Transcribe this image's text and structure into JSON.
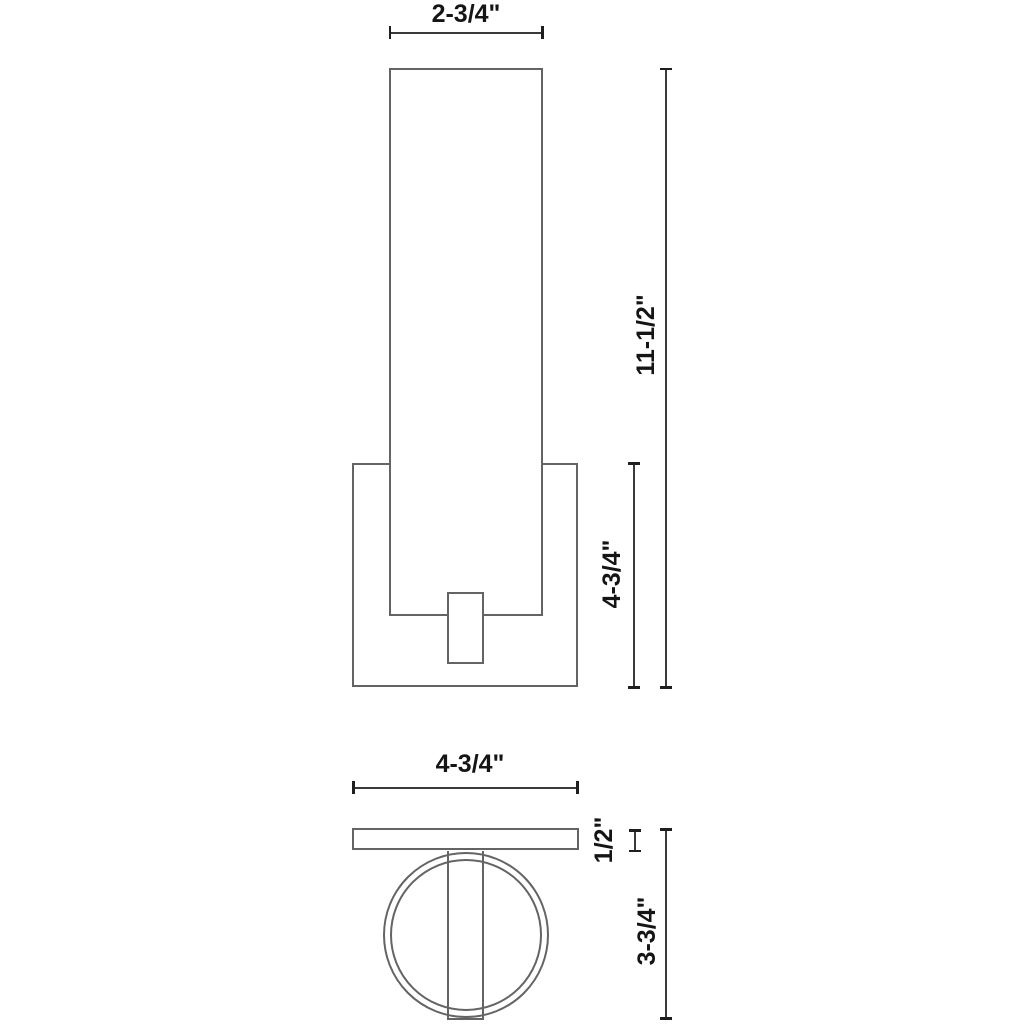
{
  "drawing": {
    "title": "wall-sconce-dimension-drawing",
    "front_view": {
      "name": "front elevation",
      "shapes": [
        "backplate",
        "cylinder-shade",
        "mounting-arm"
      ],
      "width_label": "2-3/4\"",
      "overall_height_label": "11-1/2\"",
      "backplate_height_label": "4-3/4\""
    },
    "bottom_view": {
      "name": "bottom / plan view",
      "shapes": [
        "backplate-edge",
        "cylinder-outer-circle",
        "cylinder-inner-circle",
        "arm-band"
      ],
      "width_label": "4-3/4\"",
      "plate_thickness_label": "1/2\"",
      "depth_label": "3-3/4\""
    },
    "colors": {
      "background": "#ffffff",
      "shape_outline": "#646464",
      "dimension_line": "#3a3a3a",
      "tick": "#1f1f1f",
      "label_text": "#151515"
    }
  }
}
